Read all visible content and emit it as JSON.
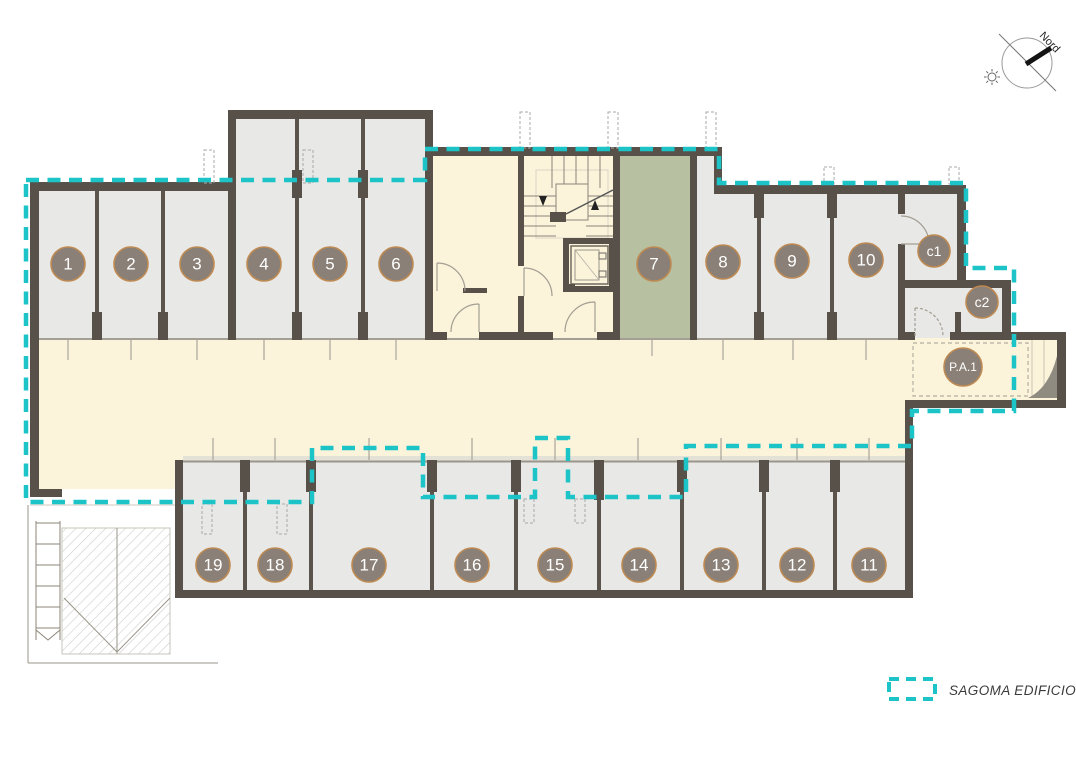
{
  "legend": {
    "label": "SAGOMA EDIFICIO"
  },
  "compass": {
    "label": "Nord"
  },
  "colors": {
    "building_outline": "#1CC4C7",
    "wall": "#57514A",
    "storage_room_fill": "#E8E8E7",
    "corridor_fill": "#FBF4DB",
    "room7_fill": "#B7C1A1",
    "badge_fill": "#8A8077",
    "badge_border": "#BE8A52"
  },
  "spaces": [
    {
      "id": "1",
      "label": "1"
    },
    {
      "id": "2",
      "label": "2"
    },
    {
      "id": "3",
      "label": "3"
    },
    {
      "id": "4",
      "label": "4"
    },
    {
      "id": "5",
      "label": "5"
    },
    {
      "id": "6",
      "label": "6"
    },
    {
      "id": "7",
      "label": "7"
    },
    {
      "id": "8",
      "label": "8"
    },
    {
      "id": "9",
      "label": "9"
    },
    {
      "id": "10",
      "label": "10"
    },
    {
      "id": "c1",
      "label": "c1"
    },
    {
      "id": "c2",
      "label": "c2"
    },
    {
      "id": "pa1",
      "label": "P.A.1"
    },
    {
      "id": "11",
      "label": "11"
    },
    {
      "id": "12",
      "label": "12"
    },
    {
      "id": "13",
      "label": "13"
    },
    {
      "id": "14",
      "label": "14"
    },
    {
      "id": "15",
      "label": "15"
    },
    {
      "id": "16",
      "label": "16"
    },
    {
      "id": "17",
      "label": "17"
    },
    {
      "id": "18",
      "label": "18"
    },
    {
      "id": "19",
      "label": "19"
    }
  ]
}
